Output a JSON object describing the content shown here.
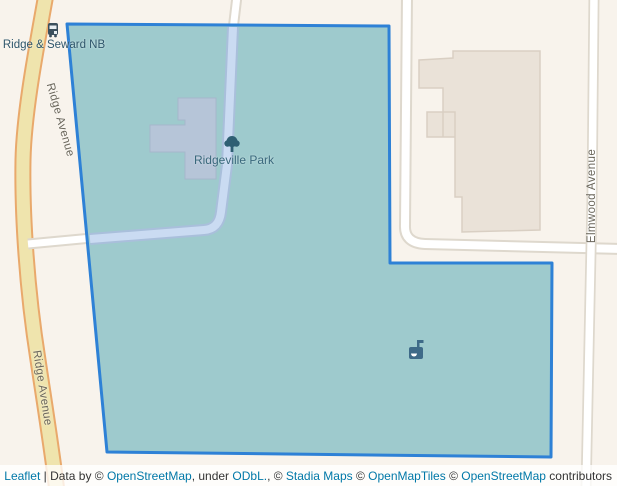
{
  "map": {
    "labels": {
      "bus_stop": "Ridge & Seward NB",
      "park": "Ridgeville Park",
      "ridge_avenue": "Ridge Avenue",
      "elmwood_avenue": "Elmwood Avenue"
    },
    "icons": {
      "bus_stop": "bus-stop-icon",
      "park": "tree-icon",
      "amenity": "park-amenity-icon"
    },
    "colors": {
      "map_background": "#f8f3ec",
      "highlight_stroke": "#2e81d6",
      "highlight_fill": "#9ecacd",
      "ridge_avenue_fill": "#efe4ad",
      "ridge_avenue_casing": "#e9a96c",
      "road_fill": "#ffffff",
      "road_casing": "#ded8cd",
      "building_fill": "#eae2d8",
      "park_building_fill": "#b6c5d8",
      "park_path_fill": "#cadbf2",
      "street_label_color": "#6b675c",
      "poi_label_color": "#39687c"
    }
  },
  "attribution": {
    "leaflet": "Leaflet",
    "separator": " | ",
    "data_by": "Data by © ",
    "osm1": "OpenStreetMap",
    "under": ", under ",
    "odbl": "ODbL.",
    "comma": ", © ",
    "stadia": "Stadia Maps",
    "copy2": " © ",
    "openmaptiles": "OpenMapTiles",
    "copy3": " © ",
    "osm2": "OpenStreetMap",
    "contributors": " contributors",
    "link_color": "#0078A8",
    "text_color": "#333333"
  }
}
